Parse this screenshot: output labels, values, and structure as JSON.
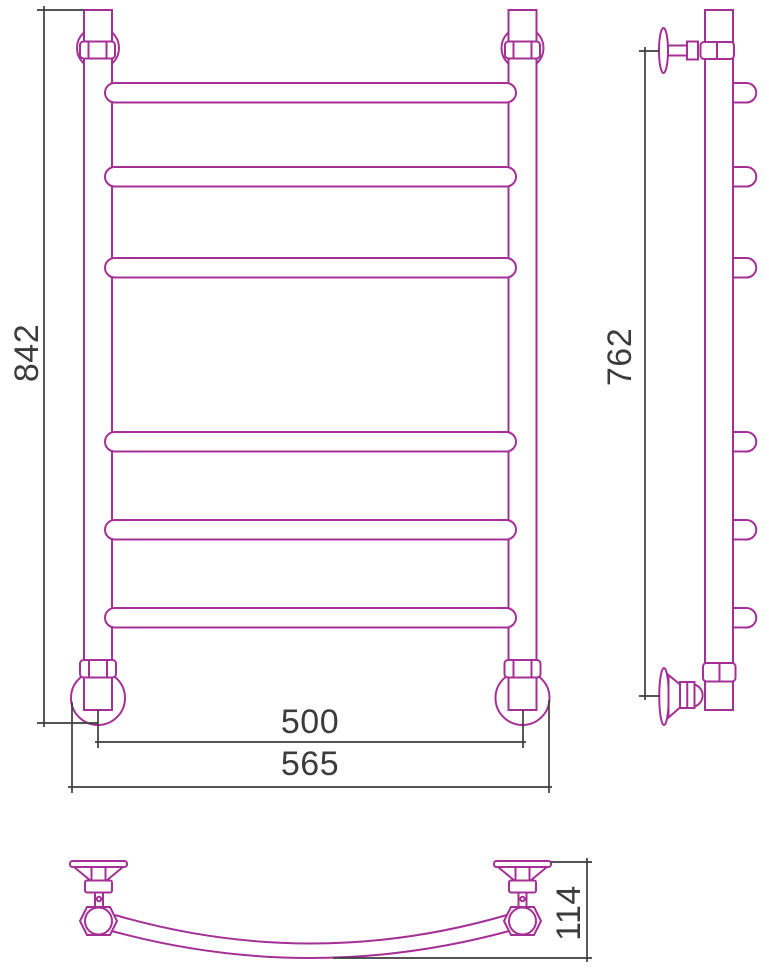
{
  "drawing": {
    "dimensions": {
      "front_height": "842",
      "side_height": "762",
      "axis_width": "500",
      "overall_width": "565",
      "depth": "114"
    },
    "colors": {
      "product_line": "#A53095",
      "dimension_line": "#3C3C3C",
      "background": "#FFFFFF"
    }
  }
}
